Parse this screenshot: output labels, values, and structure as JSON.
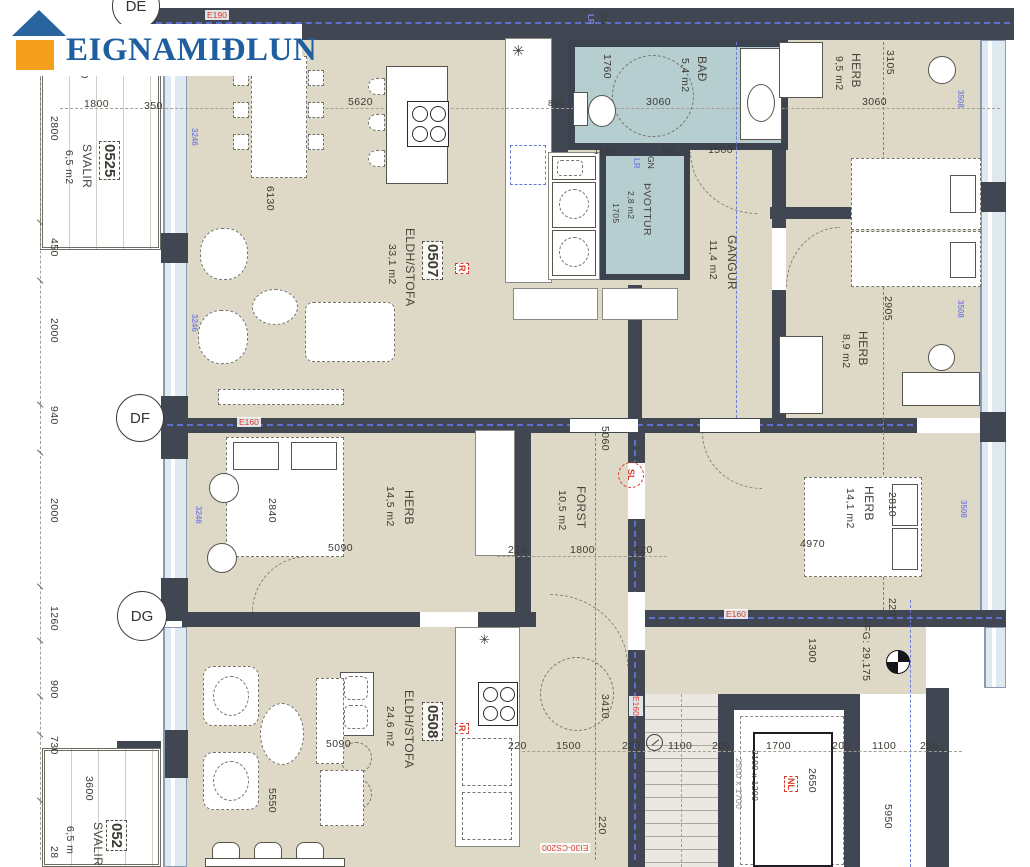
{
  "logo": {
    "brand": "EIGNAMIÐLUN",
    "blue": "#1f5fa0",
    "orange": "#f5a01d"
  },
  "markers": {
    "de": "DE",
    "df": "DF",
    "dg": "DG",
    "sl": "SL",
    "nl": "NL",
    "r": "R"
  },
  "wall_tags": {
    "e190": "E190",
    "e160": "E160",
    "ei30": "EI30-CS200"
  },
  "door_tags": {
    "lr": "LR",
    "gn": "GN"
  },
  "window_tags": {
    "w3246": "3246",
    "w3508": "3508"
  },
  "apartments": {
    "a0507": {
      "id": "0507",
      "type": "ELDH/STOFA",
      "area": "33,1 m2"
    },
    "a0508": {
      "id": "0508",
      "type": "ELDH/STOFA",
      "area": "24,6 m2"
    },
    "b0525": {
      "id": "0525",
      "type": "SVALIR",
      "area": "6,5 m2"
    },
    "b052x": {
      "id": "052",
      "type": "SVALIR",
      "area": "6,5 m"
    }
  },
  "rooms": {
    "bad": {
      "name": "BAÐ",
      "area": "5,4 m2"
    },
    "pvottur": {
      "name": "ÞVOTTUR",
      "area": "2,8 m2"
    },
    "gangur": {
      "name": "GANGUR",
      "area": "11,4 m2"
    },
    "herb95": {
      "name": "HERB",
      "area": "9,5 m2"
    },
    "herb89": {
      "name": "HERB",
      "area": "8,9 m2"
    },
    "herb145": {
      "name": "HERB",
      "area": "14,5 m2"
    },
    "forst": {
      "name": "FORST",
      "area": "10,5 m2"
    },
    "herb141": {
      "name": "HERB",
      "area": "14,1 m2"
    }
  },
  "dims": {
    "left_chain": [
      "2800",
      "450",
      "2000",
      "940",
      "2000",
      "1260",
      "900",
      "730",
      "28"
    ],
    "balcony_top": {
      "d600": "600",
      "d1800": "1800",
      "d350": "350"
    },
    "living": {
      "d5620": "5620",
      "d6130": "6130"
    },
    "bad": {
      "d1760": "1760",
      "d3060": "3060",
      "d845": "845",
      "d1630": "1630",
      "d145": "145"
    },
    "pvottur": {
      "d1705": "1705"
    },
    "gangur": {
      "d1500": "1500"
    },
    "herb95": {
      "d3105": "3105",
      "d3060": "3060"
    },
    "herb89": {
      "d2905": "2905"
    },
    "herb145": {
      "d2840": "2840",
      "d5090": "5090"
    },
    "forst": {
      "d5060": "5060",
      "d220": "220",
      "d1800": "1800",
      "d120": "120"
    },
    "herb141": {
      "d2810": "2810",
      "d4970": "4970"
    },
    "a0508": {
      "d5550": "5550",
      "d5090": "5090",
      "d3410": "3410",
      "d220": "220"
    },
    "balcony_low": {
      "d3600": "3600"
    },
    "bottom_chain": [
      "220",
      "1500",
      "220",
      "1100",
      "200",
      "1700",
      "200",
      "1100",
      "250"
    ],
    "stair": {
      "d1300": "1300",
      "d2650": "2650",
      "d5950": "5950",
      "d220": "220"
    },
    "lift": {
      "cab": "2100 x 1200",
      "shaft": "2500 x 1700"
    }
  },
  "annotations": {
    "ffg": "FFG: 29,175",
    "star": "✳"
  }
}
